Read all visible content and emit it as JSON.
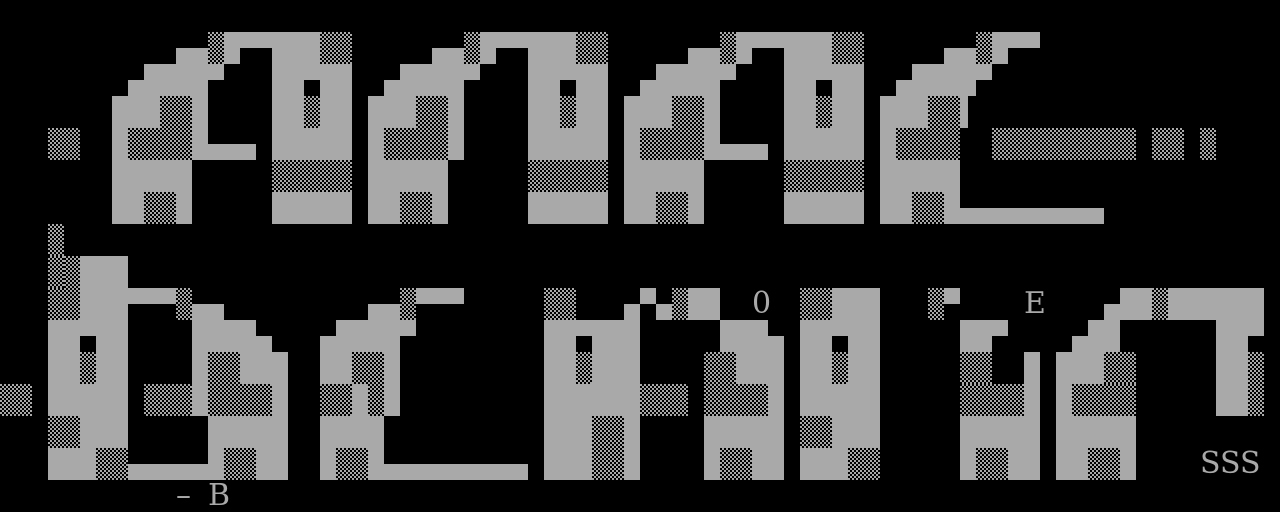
{
  "screen": {
    "width": 1280,
    "height": 512,
    "background_color": "#000000",
    "foreground_color": "#a9a9a9"
  },
  "art": {
    "description": "monochrome ANSI block-letter art on black terminal screen",
    "grid": {
      "cols": 80,
      "rows": 16,
      "cell_width": 16,
      "cell_height": 32,
      "legend": {
        ".": "empty",
        "F": "full-block",
        "T": "top-half-block",
        "B": "bottom-half-block",
        "9": "left-half-block",
        "L": "light-shade-dots-on-black",
        "M": "medium-shade-checker",
        "D": "dark-shade-dots-on-gray"
      },
      "rows_data": [
        "................................................................................",
        "...........BBLFTTFFFLL.....BBLFTTFFFLL.....BBLFTTFFFLL.....BBLFTT...............",
        "........BFFFFT...FFTFF..BFFFFT...FFTFF..BFFFFT...FFTFF..BFFFFT..................",
        ".......FFFDDF....FFLFF.FFFDDF....FFLFF.FFFDDF....FFLFF.FFFDD9...................",
        "...LL..FDDDMFBBB.FFFFF.FDDDMF....FFFFF.FDDDMFBBB.FFFFF.FDDDM..LLLLLLLLL.LL.L....",
        ".......FFFFF.....LLLLL.FFFFF.....LLLLL.FFFFF.....LLLLL.FFFFF....................",
        ".......FFDDF.....FFFFF.FFDDF.....FFFFF.FFDDF.....FFFFF.FFDDFBBBBBBBBB...........",
        "...L............................................................................",
        "...MLFFF........................................................................",
        "...LLFFFTTTLBB.........BBLTTT.....LL...BTBLFF.....LLFFF...LT.........BFFLFFFFFF.",
        "...FFTFF....FFFFB...BFFFFT........FFTFFF.....FFFB.FFTFF.....FFT....BFF......FFT.",
        "...FFLFF....FDDFFF..FFDDF.........FFLFFF....DDFFF.FFLFF.....LL..F.FFFLL.....FFL.",
        "LL.FFFFF.LLLFMDDDF..LLFMF.........FFFFFFLLL.MDDDF.FFFFF.....MDDDF.FDDDM.....FFL.",
        "...DDFFF.....FFFFF..FFFF..........FFFDDF....FFFFF.DDFFF.....FFFFF.FFFFF.........",
        "...FFFDMBBBBBFDDFF..FDDFBBBBBBBBB.FFFDMF....FDDFF.FFFDM.....FDDFF.FFDDF.........",
        "................................................................................"
      ]
    },
    "texts": [
      {
        "col": 47,
        "row": 9,
        "text": "0"
      },
      {
        "col": 64,
        "row": 9,
        "text": "E"
      },
      {
        "col": 75,
        "row": 14,
        "text": "SSS"
      },
      {
        "col": 11,
        "row": 15,
        "text": "–"
      },
      {
        "col": 13,
        "row": 15,
        "text": "B"
      }
    ]
  }
}
